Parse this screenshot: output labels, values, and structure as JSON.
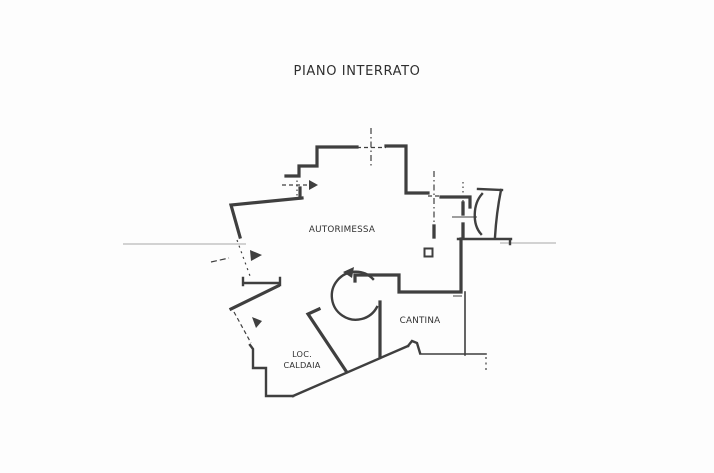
{
  "title": "PIANO INTERRATO",
  "rooms": {
    "garage": {
      "label": "AUTORIMESSA"
    },
    "cellar": {
      "label": "CANTINA"
    },
    "boiler_room": {
      "label_line_1": "LOC.",
      "label_line_2": "CALDAIA"
    }
  },
  "colors": {
    "paper": "#fdfdfd",
    "ink": "#3f3f3f",
    "faint-line": "#a8a8a8",
    "text": "#2f2f2f"
  }
}
